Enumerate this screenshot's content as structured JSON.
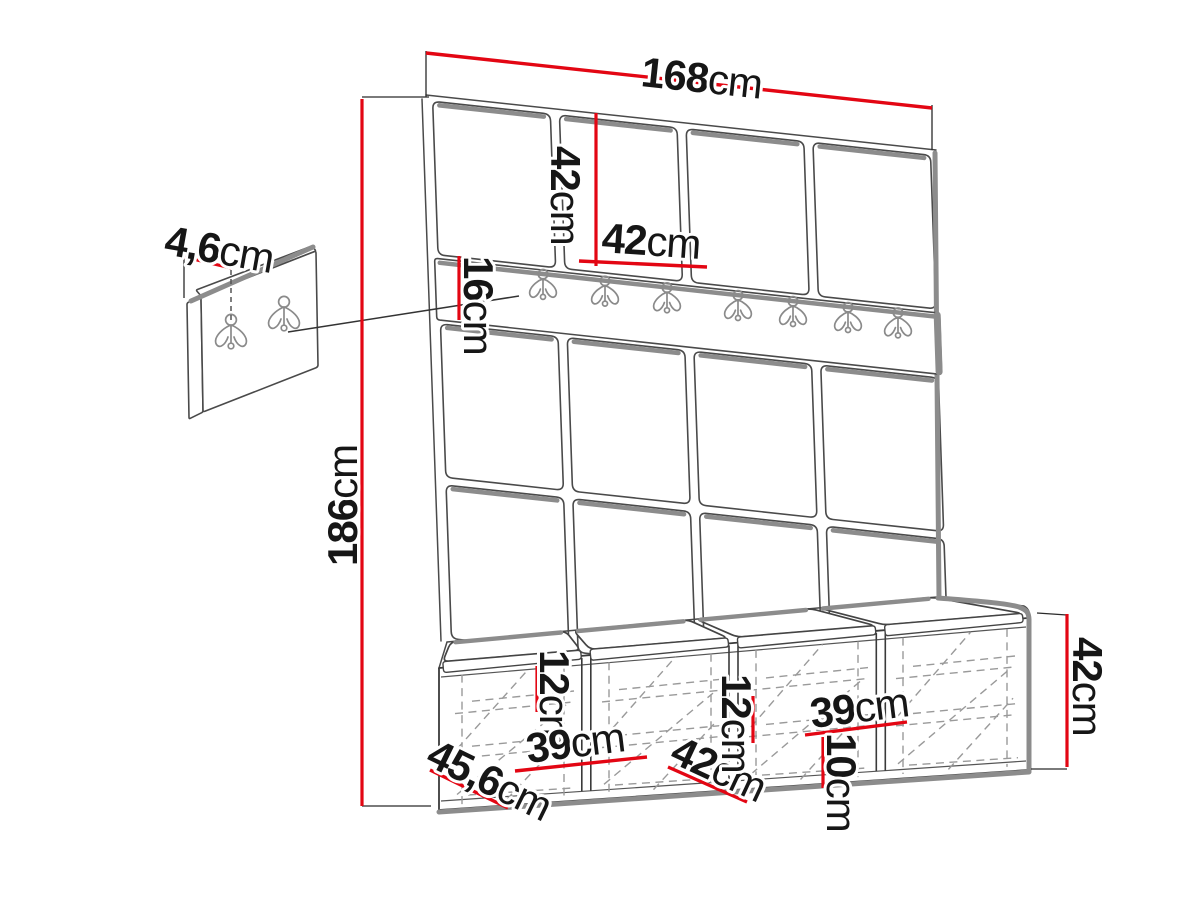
{
  "diagram": {
    "title": "Hallway wardrobe set dimension drawing",
    "background": "#ffffff",
    "colors": {
      "dimension_line": "#e30613",
      "drawing_line": "#3a3a3a",
      "shadow_line": "#8c8c8c",
      "hidden_line": "#9a9a9a",
      "text": "#161616"
    },
    "main_unit": {
      "description": "wall panel unit with upholstered squares, hook rail and storage bench",
      "panel_columns": 4,
      "panel_rows": 3,
      "rail_hooks": 7,
      "bench_compartments": 4,
      "bench_cushions": 4
    },
    "accessory_panel": {
      "description": "small wall hook panel",
      "hooks": 2
    },
    "dimensions": [
      {
        "id": "width_total",
        "value": "168",
        "unit": "cm"
      },
      {
        "id": "panel_height",
        "value": "42",
        "unit": "cm"
      },
      {
        "id": "panel_width",
        "value": "42",
        "unit": "cm"
      },
      {
        "id": "rail_height",
        "value": "16",
        "unit": "cm"
      },
      {
        "id": "height_total",
        "value": "186",
        "unit": "cm"
      },
      {
        "id": "accessory_depth",
        "value": "4,6",
        "unit": "cm"
      },
      {
        "id": "niche_top_left",
        "value": "12",
        "unit": "cm"
      },
      {
        "id": "niche_width_left",
        "value": "39",
        "unit": "cm"
      },
      {
        "id": "bench_depth",
        "value": "45,6",
        "unit": "cm"
      },
      {
        "id": "niche_width_mid",
        "value": "42",
        "unit": "cm"
      },
      {
        "id": "niche_top_mid",
        "value": "12",
        "unit": "cm"
      },
      {
        "id": "niche_width_right",
        "value": "39",
        "unit": "cm"
      },
      {
        "id": "niche_top_right",
        "value": "10",
        "unit": "cm"
      },
      {
        "id": "bench_height",
        "value": "42",
        "unit": "cm"
      }
    ]
  }
}
